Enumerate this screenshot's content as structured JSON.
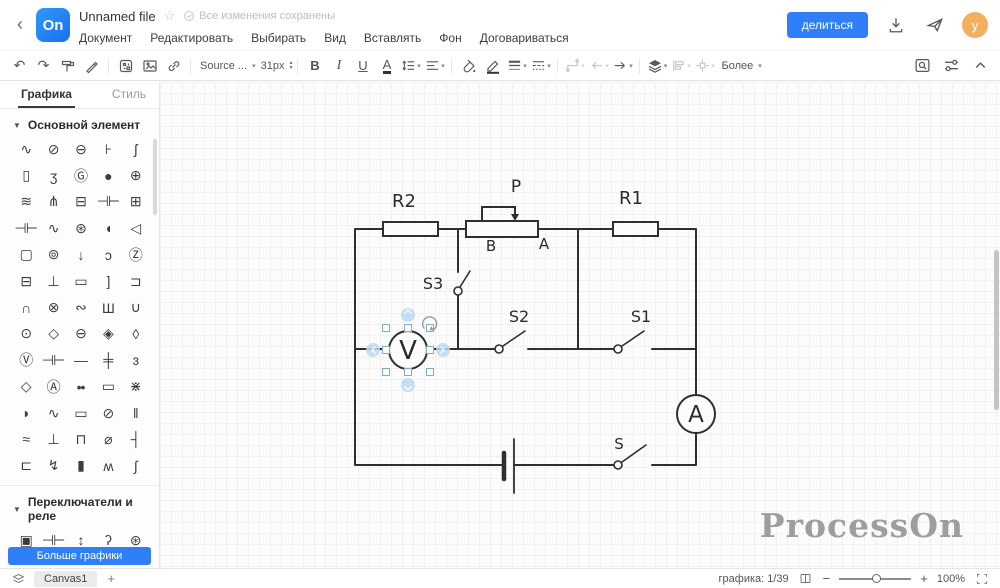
{
  "header": {
    "logo": "On",
    "title": "Unnamed file",
    "saved_status": "Все изменения сохранены",
    "menu": [
      "Документ",
      "Редактировать",
      "Выбирать",
      "Вид",
      "Вставлять",
      "Фон",
      "Договариваться"
    ],
    "share_button": "делиться",
    "avatar_initial": "y",
    "icons": [
      "back-icon",
      "star-icon",
      "saved-check-icon",
      "download-icon",
      "send-icon"
    ]
  },
  "toolbar": {
    "font_family": "Source ...",
    "font_size": "31px",
    "bold_label": "B",
    "italic_label": "I",
    "underline_label": "U",
    "font_color_label": "A",
    "more_label": "Более",
    "icon_names": [
      "undo-icon",
      "redo-icon",
      "format-painter-icon",
      "brush-icon",
      "qr-table-icon",
      "image-icon",
      "link-icon",
      "line-spacing-icon",
      "align-text-icon",
      "fill-color-icon",
      "line-color-icon",
      "line-width-icon",
      "line-style-icon",
      "connector-icon",
      "arrow-start-icon",
      "arrow-end-icon",
      "layers-icon",
      "align-objects-icon",
      "distribute-icon",
      "find-replace-icon",
      "adjust-icon",
      "collapse-icon"
    ]
  },
  "sidebar": {
    "tabs": [
      {
        "label": "Графика",
        "active": true
      },
      {
        "label": "Стиль",
        "active": false
      }
    ],
    "sections": [
      {
        "title": "Основной элемент",
        "rows": [
          [
            "∿",
            "⊘",
            "⊖",
            "⊦",
            "ʃ"
          ],
          [
            "▯",
            "ʒ",
            "Ⓖ",
            "●",
            "⊕"
          ],
          [
            "≋",
            "⋔",
            "⊟",
            "⊣⊢",
            "⊞"
          ],
          [
            "⊣⊢",
            "∿",
            "⊛",
            "◖",
            "◁"
          ],
          [
            "▢",
            "⊚",
            "↓",
            "ɔ",
            "Ⓩ"
          ],
          [
            "⊟",
            "⊥",
            "▭",
            "]",
            "⊐"
          ],
          [
            "∩",
            "⊗",
            "∾",
            "Ш",
            "∪"
          ],
          [
            "⊙",
            "◇",
            "⊖",
            "◈",
            "◊"
          ],
          [
            "Ⓥ",
            "⊣⊢",
            "—",
            "╪",
            "ɜ"
          ],
          [
            "◇",
            "Ⓐ",
            "••",
            "▭",
            "⋇"
          ],
          [
            "◗",
            "∿",
            "▭",
            "⊘",
            "‖"
          ],
          [
            "≈",
            "⊥",
            "⊓",
            "⌀",
            "┤"
          ],
          [
            "⊏",
            "↯",
            "▮",
            "ʍ",
            "∫"
          ]
        ]
      },
      {
        "title": "Переключатели и реле",
        "rows": [
          [
            "▣",
            "⊣⊢",
            "↕",
            "ʔ",
            "⊛"
          ]
        ]
      }
    ],
    "more_button": "Больше графики"
  },
  "canvas": {
    "labels": {
      "r2": "R2",
      "p": "P",
      "r1": "R1",
      "pot_b": "B",
      "pot_a": "A",
      "s3": "S3",
      "s2": "S2",
      "s1": "S1",
      "s": "S",
      "voltmeter": "V",
      "ammeter": "A"
    },
    "watermark": "ProcessOn"
  },
  "statusbar": {
    "sheet_tab": "Canvas1",
    "add_tab": "+",
    "graphics_label": "графика:",
    "graphics_count": "1/39",
    "zoom_level": "100%"
  }
}
